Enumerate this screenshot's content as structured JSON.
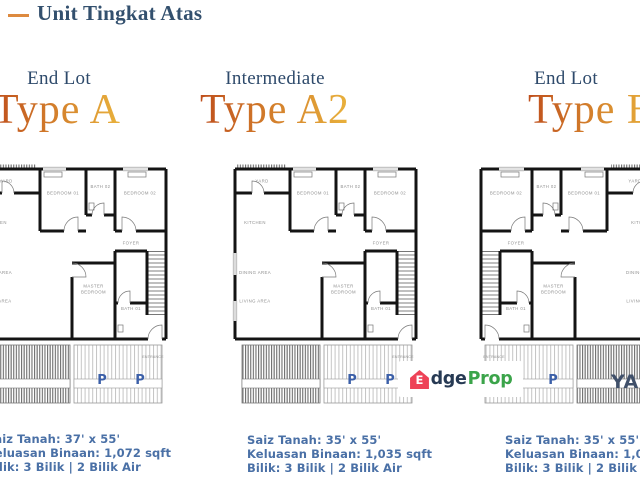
{
  "header": {
    "title": "Unit Tingkat Atas"
  },
  "colors": {
    "accent_dash": "#dd8a3f",
    "heading_navy": "#2e4a6b",
    "type_gradient_start": "#bf4f1c",
    "type_gradient_end": "#e9b23c",
    "spec_text": "#4a70a6",
    "parking_letter": "#3b5fa8",
    "brand_red": "#ee4257",
    "brand_navy": "#273a54",
    "brand_green": "#3ba44a"
  },
  "watermark": {
    "brand_e": "E",
    "brand_mid": "dge",
    "brand_suffix": "Prop"
  },
  "clipped_fragment": "YA",
  "units": [
    {
      "category": "End Lot",
      "type_name": "Type A",
      "specs": [
        "Saiz Tanah: 37' x 55'",
        "Keluasan Binaan: 1,072 sqft",
        "Bilik: 3 Bilik | 2 Bilik Air"
      ],
      "rooms": {
        "yard": "YARD",
        "bedroom01": "BEDROOM 01",
        "bedroom02": "BEDROOM 02",
        "bath02": "BATH 02",
        "bath01": "BATH 01",
        "kitchen": "KITCHEN",
        "foyer": "FOYER",
        "dining": "DINING AREA",
        "living": "LIVING AREA",
        "master_line1": "MASTER",
        "master_line2": "BEDROOM",
        "entrance": "ENTRANCE",
        "parking": "P"
      }
    },
    {
      "category": "Intermediate",
      "type_name": "Type A2",
      "specs": [
        "Saiz Tanah: 35' x 55'",
        "Keluasan Binaan: 1,035 sqft",
        "Bilik: 3 Bilik | 2 Bilik Air"
      ],
      "rooms": {
        "yard": "YARD",
        "bedroom01": "BEDROOM 01",
        "bedroom02": "BEDROOM 02",
        "bath02": "BATH 02",
        "bath01": "BATH 01",
        "kitchen": "KITCHEN",
        "foyer": "FOYER",
        "dining": "DINING AREA",
        "living": "LIVING AREA",
        "master_line1": "MASTER",
        "master_line2": "BEDROOM",
        "entrance": "ENTRANCE",
        "parking": "P"
      }
    },
    {
      "category": "End Lot",
      "type_name": "Type B",
      "specs": [
        "Saiz Tanah: 35' x 55'",
        "Keluasan Binaan: 1,035 sqft",
        "Bilik: 3 Bilik | 2 Bilik Air"
      ],
      "rooms": {
        "yard": "YARD",
        "bedroom01": "BEDROOM 01",
        "bedroom02": "BEDROOM 02",
        "bath02": "BATH 02",
        "bath01": "BATH 01",
        "kitchen": "KITCHEN",
        "foyer": "FOYER",
        "dining": "DINING AREA",
        "living": "LIVING AREA",
        "master_line1": "MASTER",
        "master_line2": "BEDROOM",
        "entrance": "ENTRANCE",
        "parking": "P"
      }
    }
  ]
}
